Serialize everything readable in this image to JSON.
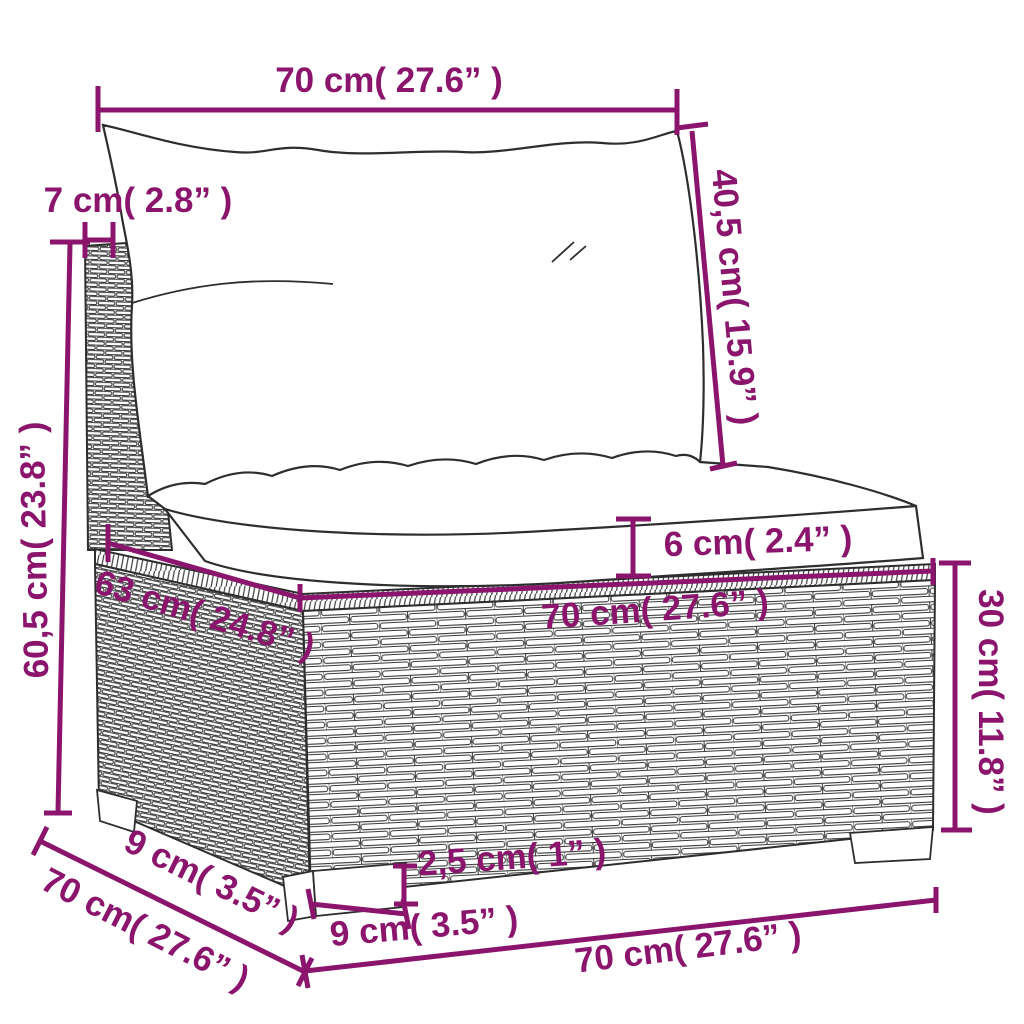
{
  "diagram": {
    "kind": "furniture-dimension-diagram",
    "product": "poly-rattan-middle-sofa-section-with-cushions"
  },
  "colors": {
    "accent": "#8B156D",
    "outline": "#2e2e2e",
    "background": "#ffffff"
  },
  "dims": {
    "top_width": "70 cm( 27.6” )",
    "back_cushion_height": "40,5 cm( 15.9” )",
    "back_frame_depth": "7 cm( 2.8” )",
    "total_height": "60,5 cm( 23.8” )",
    "seat_cushion_thickness": "6 cm( 2.4” )",
    "seat_width": "70 cm( 27.6” )",
    "seat_depth": "63 cm( 24.8” )",
    "base_height": "30 cm( 11.8” )",
    "leg_offset_side": "9 cm( 3.5” )",
    "total_depth": "70 cm( 27.6” )",
    "leg_height": "2,5 cm( 1” )",
    "leg_width": "9 cm( 3.5” )",
    "base_width": "70 cm( 27.6” )"
  }
}
